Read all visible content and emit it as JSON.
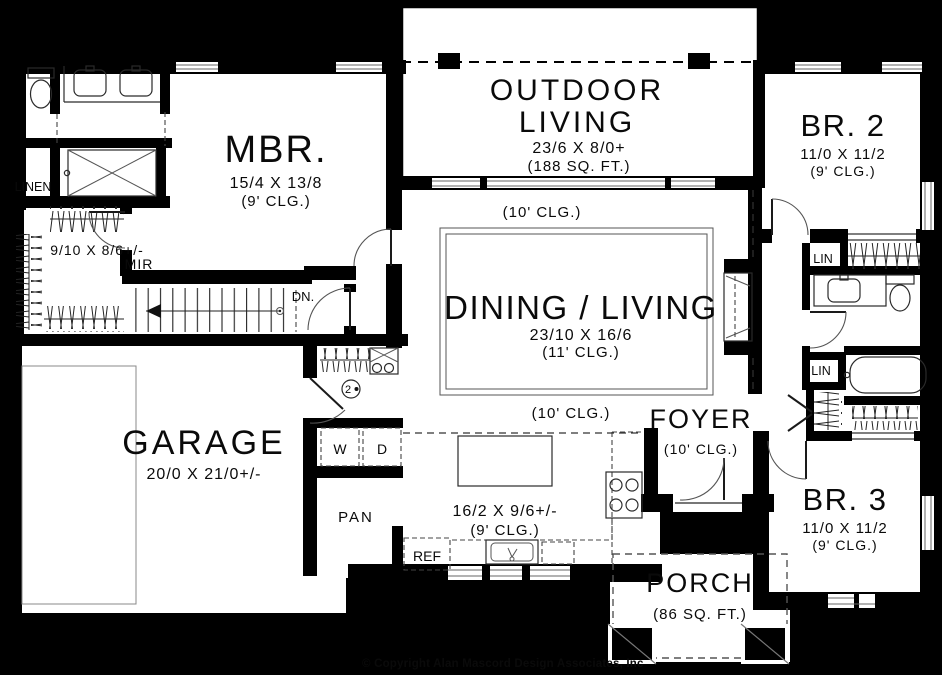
{
  "plan": {
    "copyright": "© Copyright Alan Mascord Design Associates, Inc",
    "keynote": "2",
    "rooms": {
      "outdoor_living": {
        "line1": "OUTDOOR",
        "line2": "LIVING",
        "dims": "23/6 X 8/0+",
        "area": "(188 SQ. FT.)"
      },
      "mbr": {
        "name": "MBR.",
        "dims": "15/4 X 13/8",
        "clg": "(9' CLG.)"
      },
      "dining_living": {
        "name": "DINING / LIVING",
        "dims": "23/10 X 16/6",
        "clg": "(11' CLG.)",
        "clg_north": "(10' CLG.)",
        "clg_south": "(10' CLG.)"
      },
      "br2": {
        "name": "BR. 2",
        "dims": "11/0 X 11/2",
        "clg": "(9' CLG.)"
      },
      "br3": {
        "name": "BR. 3",
        "dims": "11/0 X 11/2",
        "clg": "(9' CLG.)"
      },
      "garage": {
        "name": "GARAGE",
        "dims": "20/0 X 21/0+/-"
      },
      "kitchen": {
        "dims": "16/2 X 9/6+/-",
        "clg": "(9' CLG.)"
      },
      "foyer": {
        "name": "FOYER",
        "clg": "(10' CLG.)"
      },
      "porch": {
        "name": "PORCH",
        "area": "(86 SQ. FT.)"
      },
      "master_closet": {
        "dims": "9/10 X 8/6+/-",
        "label": "MIR"
      },
      "linen": {
        "label": "LINEN"
      },
      "lin_upper": {
        "label": "LIN"
      },
      "lin_lower": {
        "label": "LIN"
      },
      "pantry": {
        "label": "PAN"
      },
      "fridge": {
        "label": "REF"
      },
      "washer": {
        "label": "W"
      },
      "dryer": {
        "label": "D"
      },
      "stairs": {
        "label": "DN."
      }
    },
    "colors": {
      "background": "#000000",
      "floor": "#ffffff",
      "wall": "#000000"
    }
  }
}
